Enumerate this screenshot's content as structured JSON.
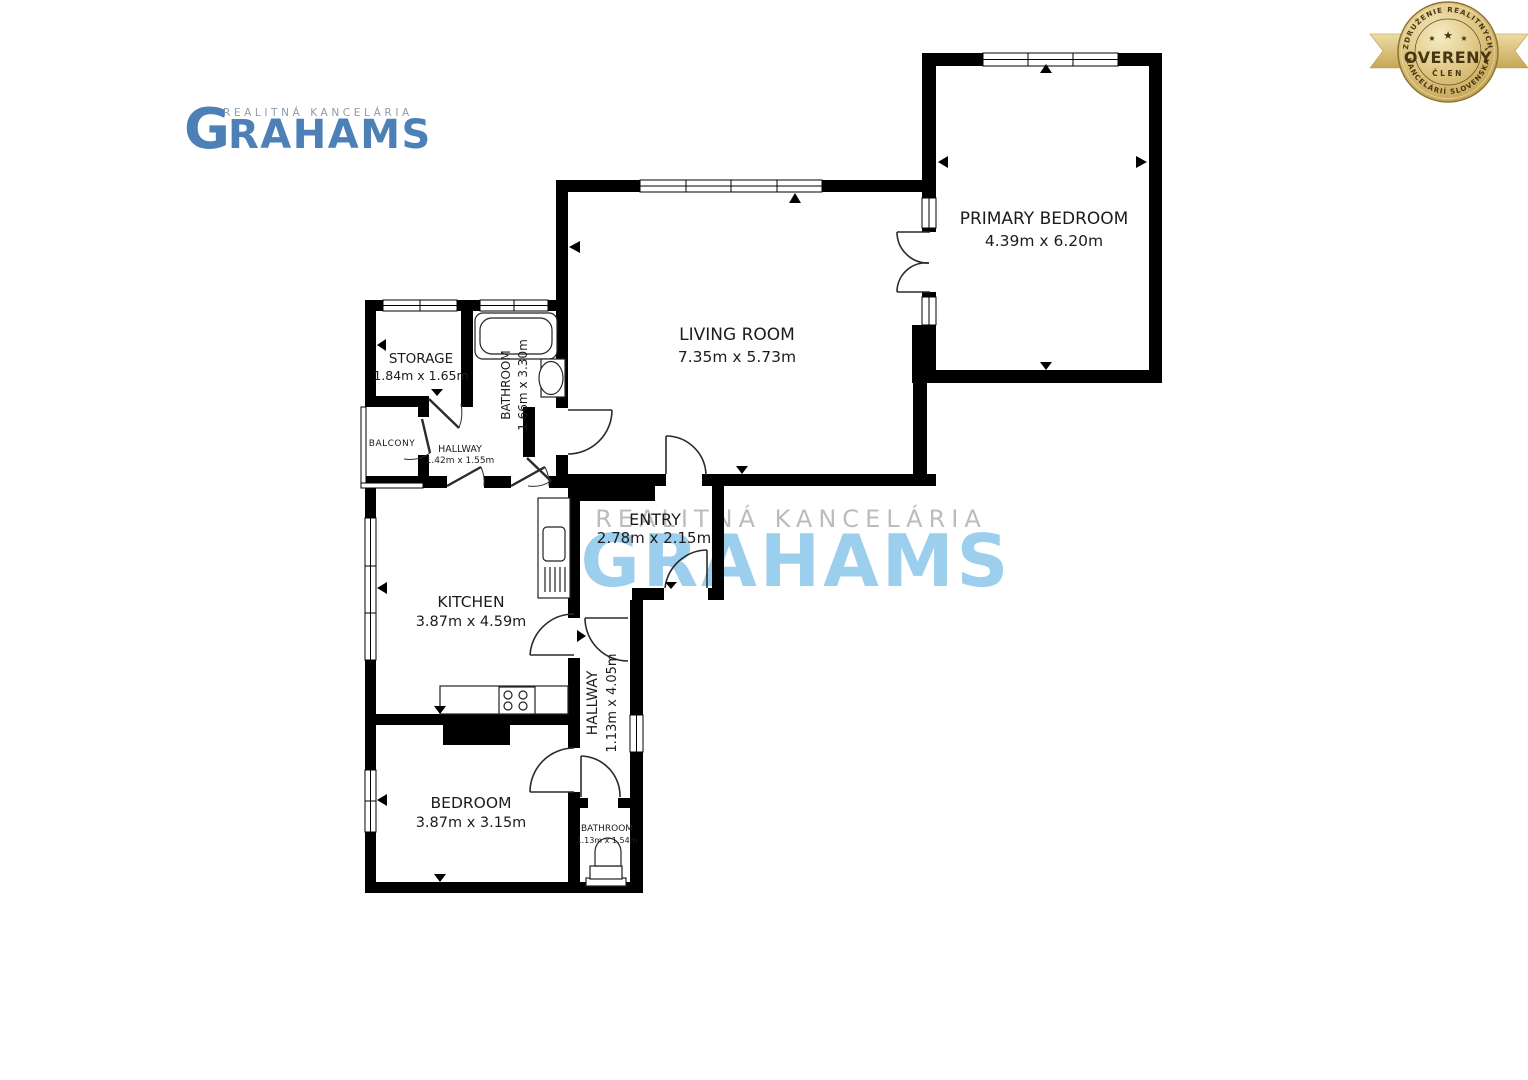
{
  "logo": {
    "tagline": "REALITNÁ KANCELÁRIA",
    "brand_initial": "G",
    "brand_rest": "RAHAMS"
  },
  "watermark": {
    "tagline": "REALITNÁ KANCELÁRIA",
    "brand": "GRAHAMS"
  },
  "badge": {
    "arc_top": "ZDRUŽENIE REALITNÝCH",
    "arc_bottom": "KANCELÁRIÍ SLOVENSKA",
    "title": "OVERENÝ",
    "subtitle": "ČLEN",
    "star": "★"
  },
  "colors": {
    "brand_blue": "#4D80B6",
    "watermark_blue": "#92C9ED",
    "badge_gold": "#C9A84C",
    "wall_black": "#000000"
  },
  "floorplan": {
    "rooms": {
      "primary_bedroom": {
        "name": "PRIMARY BEDROOM",
        "dims": "4.39m x 6.20m"
      },
      "living_room": {
        "name": "LIVING ROOM",
        "dims": "7.35m x 5.73m"
      },
      "storage": {
        "name": "STORAGE",
        "dims": "1.84m x 1.65m"
      },
      "bathroom_main": {
        "name": "BATHROOM",
        "dims": "1.66m x 3.30m"
      },
      "balcony": {
        "name": "BALCONY",
        "dims": ""
      },
      "hallway_small": {
        "name": "HALLWAY",
        "dims": "1.42m x 1.55m"
      },
      "entry": {
        "name": "ENTRY",
        "dims": "2.78m x 2.15m"
      },
      "kitchen": {
        "name": "KITCHEN",
        "dims": "3.87m x 4.59m"
      },
      "hallway_main": {
        "name": "HALLWAY",
        "dims": "1.13m x 4.05m"
      },
      "bedroom": {
        "name": "BEDROOM",
        "dims": "3.87m x 3.15m"
      },
      "bathroom_small": {
        "name": "BATHROOM",
        "dims": "1.13m x 1.54m"
      }
    }
  }
}
